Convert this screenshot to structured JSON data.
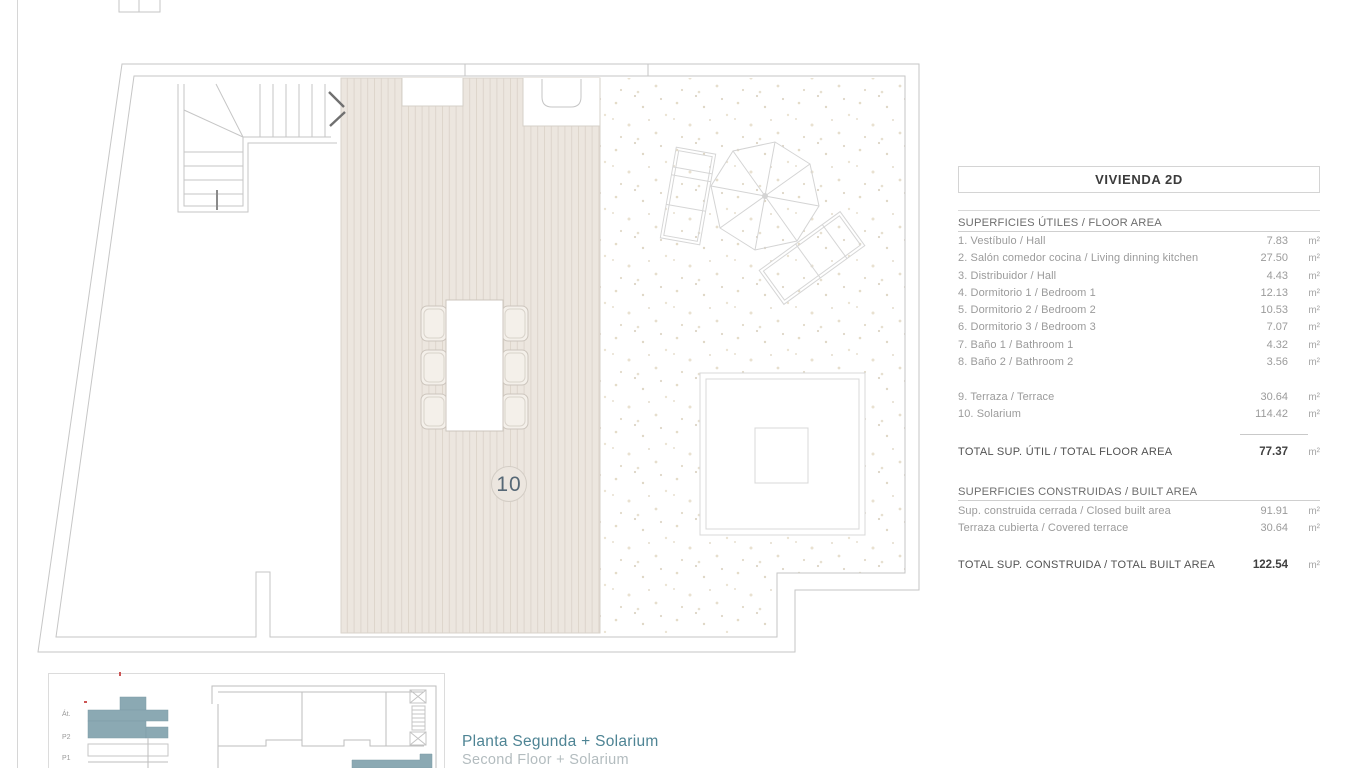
{
  "panel": {
    "title": "VIVIENDA 2D",
    "floor_area": {
      "header": "SUPERFICIES ÚTILES / FLOOR AREA",
      "rows": [
        {
          "name": "1. Vestíbulo / Hall",
          "value": "7.83",
          "unit": "m²"
        },
        {
          "name": "2. Salón comedor cocina / Living dinning kitchen",
          "value": "27.50",
          "unit": "m²"
        },
        {
          "name": "3. Distribuidor / Hall",
          "value": "4.43",
          "unit": "m²"
        },
        {
          "name": "4. Dormitorio 1 / Bedroom 1",
          "value": "12.13",
          "unit": "m²"
        },
        {
          "name": "5. Dormitorio 2 / Bedroom 2",
          "value": "10.53",
          "unit": "m²"
        },
        {
          "name": "6. Dormitorio 3 / Bedroom 3",
          "value": "7.07",
          "unit": "m²"
        },
        {
          "name": "7. Baño 1 / Bathroom 1",
          "value": "4.32",
          "unit": "m²"
        },
        {
          "name": "8. Baño 2 / Bathroom 2",
          "value": "3.56",
          "unit": "m²"
        }
      ],
      "extra_rows": [
        {
          "name": "9. Terraza / Terrace",
          "value": "30.64",
          "unit": "m²"
        },
        {
          "name": "10. Solarium",
          "value": "114.42",
          "unit": "m²"
        }
      ],
      "total": {
        "label": "TOTAL SUP. ÚTIL / TOTAL FLOOR AREA",
        "value": "77.37",
        "unit": "m²"
      }
    },
    "built_area": {
      "header": "SUPERFICIES CONSTRUIDAS / BUILT AREA",
      "rows": [
        {
          "name": "Sup. construida cerrada / Closed built area",
          "value": "91.91",
          "unit": "m²"
        },
        {
          "name": "Terraza cubierta / Covered terrace",
          "value": "30.64",
          "unit": "m²"
        }
      ],
      "total": {
        "label": "TOTAL SUP. CONSTRUIDA /  TOTAL BUILT AREA",
        "value": "122.54",
        "unit": "m²"
      }
    }
  },
  "plan": {
    "room_number_label": "10"
  },
  "key_diagram": {
    "levels": [
      "Át.",
      "P2",
      "P1"
    ]
  },
  "caption": {
    "es": "Planta Segunda + Solarium",
    "en": "Second Floor + Solarium"
  },
  "colors": {
    "accent_teal": "#8ba9b3",
    "caption_teal": "#4e8494",
    "deck_fill": "#ece6df",
    "plan_line": "#c6c6c6"
  }
}
